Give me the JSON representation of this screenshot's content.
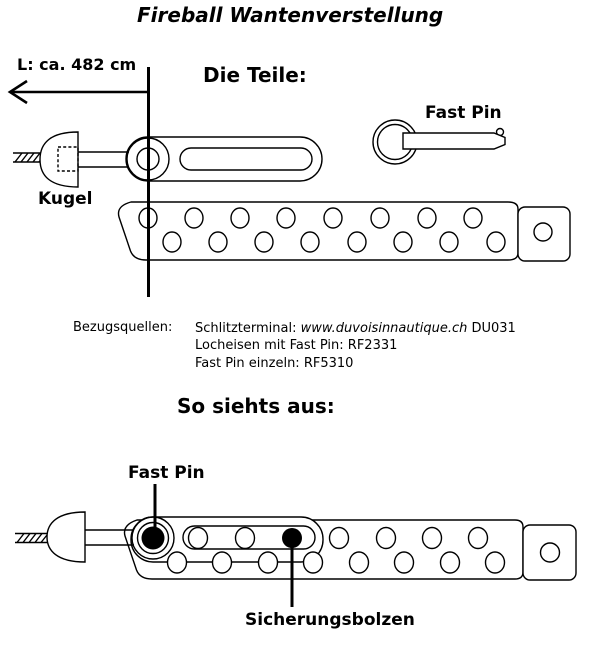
{
  "title": "Fireball Wantenverstellung",
  "dimension": {
    "label": "L: ca. 482 cm"
  },
  "sections": {
    "parts": "Die Teile:",
    "assembly": "So siehts aus:"
  },
  "labels": {
    "fast_pin_part": "Fast Pin",
    "kugel": "Kugel",
    "fast_pin_assembly": "Fast Pin",
    "sicherungsbolzen": "Sicherungsbolzen"
  },
  "sources": {
    "heading": "Bezugsquellen:",
    "line1": {
      "prefix": "Schlitzterminal: ",
      "url": "www.duvoisinnautique.ch",
      "suffix": " DU031"
    },
    "line2": "Locheisen mit Fast Pin: RF2331",
    "line3": "Fast Pin einzeln: RF5310"
  },
  "colors": {
    "ink": "#000000",
    "background": "#ffffff"
  }
}
